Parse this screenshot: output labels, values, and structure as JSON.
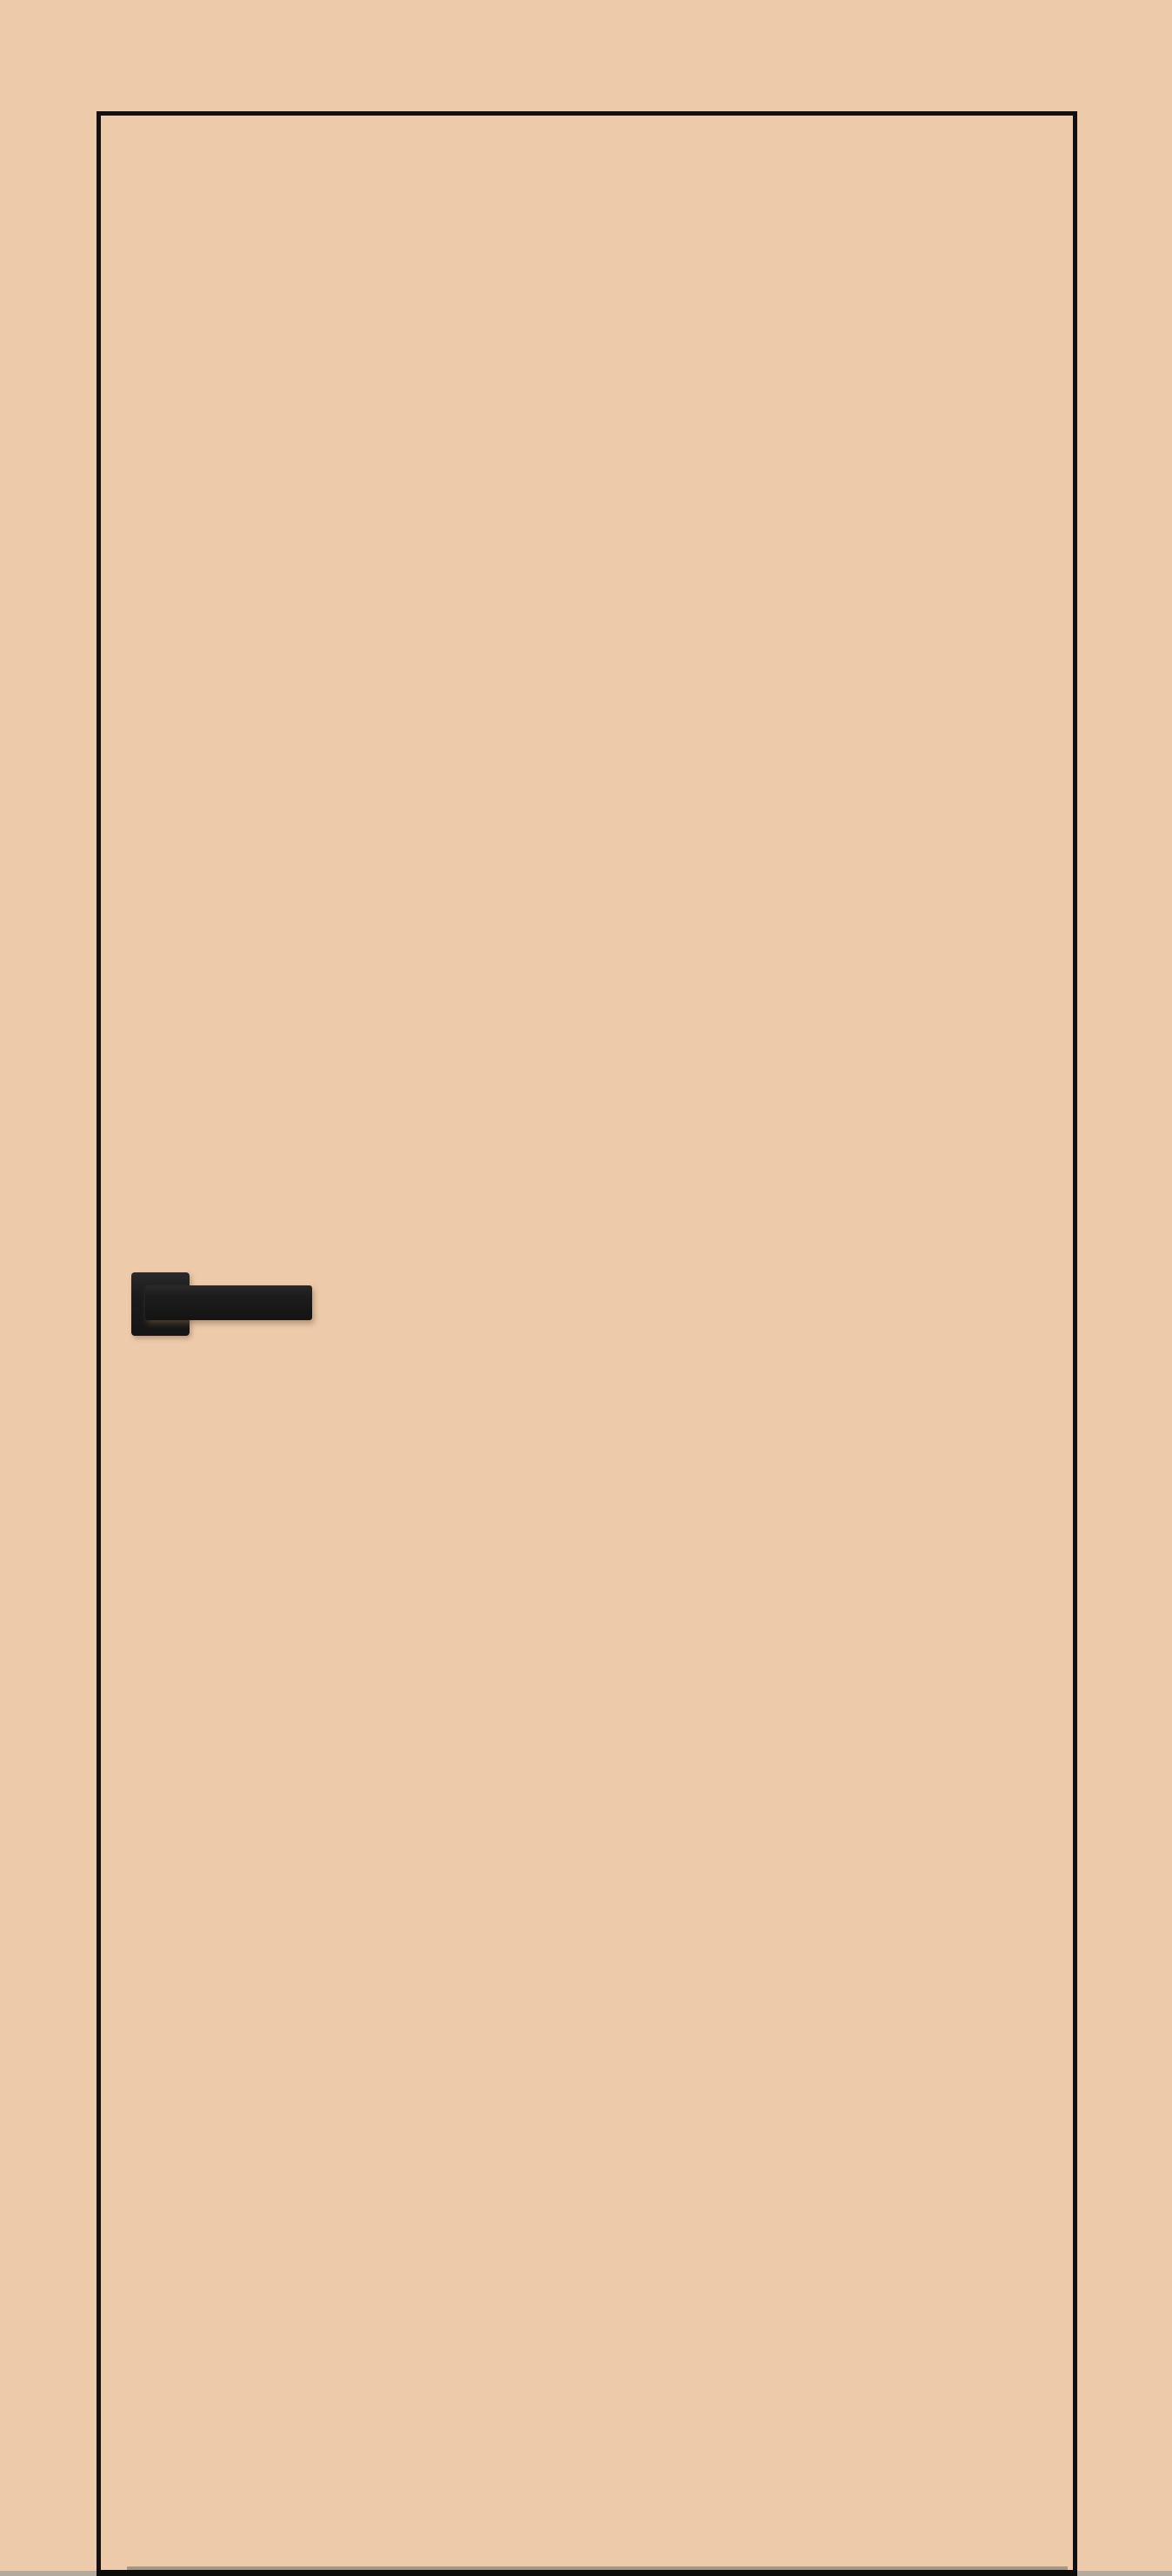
{
  "scene": {
    "subject": "concealed flush interior door painted same color as wall, thin black edge seam, black square lever handle, narrow floor strip at bottom",
    "text_content": ""
  },
  "colors": {
    "wall": "#edcbaa",
    "door": "#edcbaa",
    "seam": "#121110",
    "handle": "#1c1c1c",
    "handle_highlight": "#2a2a2a",
    "door_bottom_edge": "#0d0b09",
    "bottom_shadow": "#8b857a",
    "floor": "#b3a99d"
  }
}
